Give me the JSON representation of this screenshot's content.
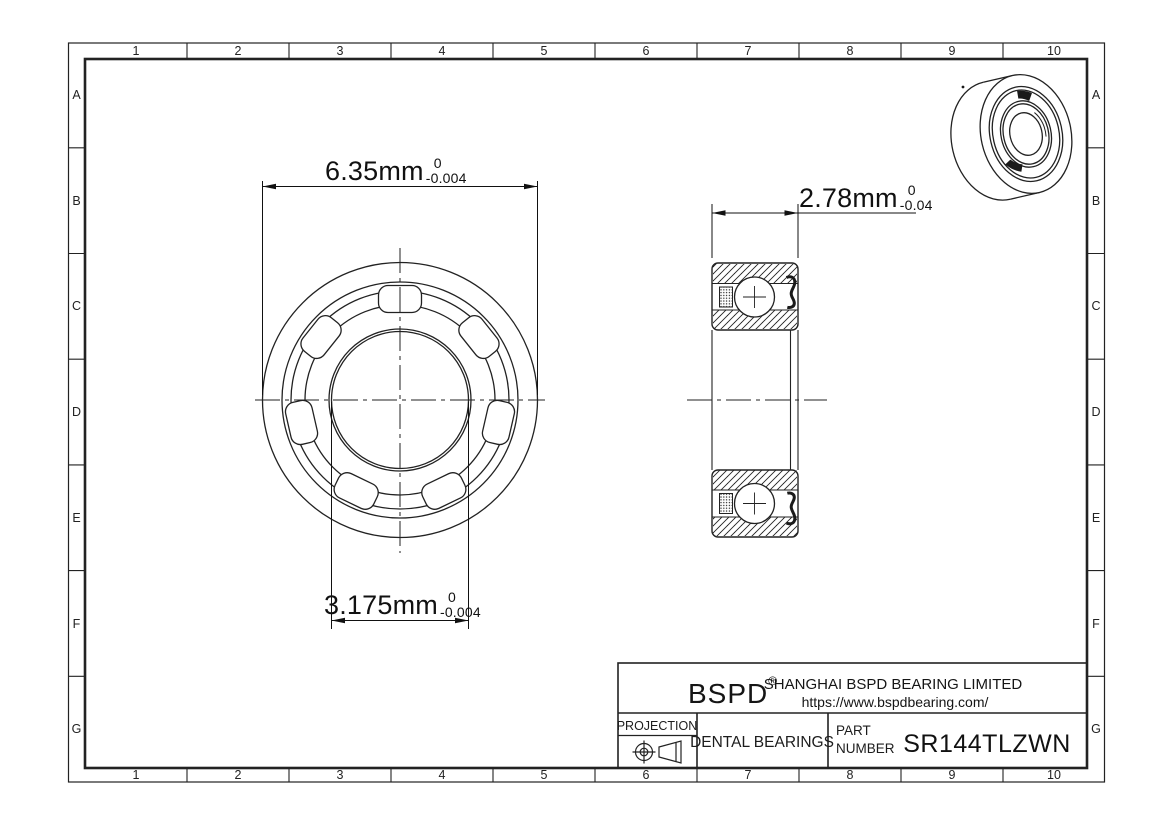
{
  "page": {
    "background": "#ffffff",
    "line_color": "#222222"
  },
  "grid": {
    "columns": [
      "1",
      "2",
      "3",
      "4",
      "5",
      "6",
      "7",
      "8",
      "9",
      "10"
    ],
    "rows": [
      "A",
      "B",
      "C",
      "D",
      "E",
      "F",
      "G"
    ]
  },
  "dimensions": {
    "outer_diameter": {
      "value": "6.35mm",
      "tol_upper": "0",
      "tol_lower": "-0.004"
    },
    "width": {
      "value": "2.78mm",
      "tol_upper": "0",
      "tol_lower": "-0.04"
    },
    "bore_diameter": {
      "value": "3.175mm",
      "tol_upper": "0",
      "tol_lower": "-0.004"
    }
  },
  "title_block": {
    "brand": "BSPD",
    "registered_mark": "®",
    "company": "SHANGHAI BSPD BEARING LIMITED",
    "website": "https://www.bspdbearing.com/",
    "projection_label": "PROJECTION",
    "product_category": "DENTAL BEARINGS",
    "part_label_line1": "PART",
    "part_label_line2": "NUMBER",
    "part_number": "SR144TLZWN"
  },
  "icons": {
    "projection_symbol": "first-angle-projection-icon"
  }
}
